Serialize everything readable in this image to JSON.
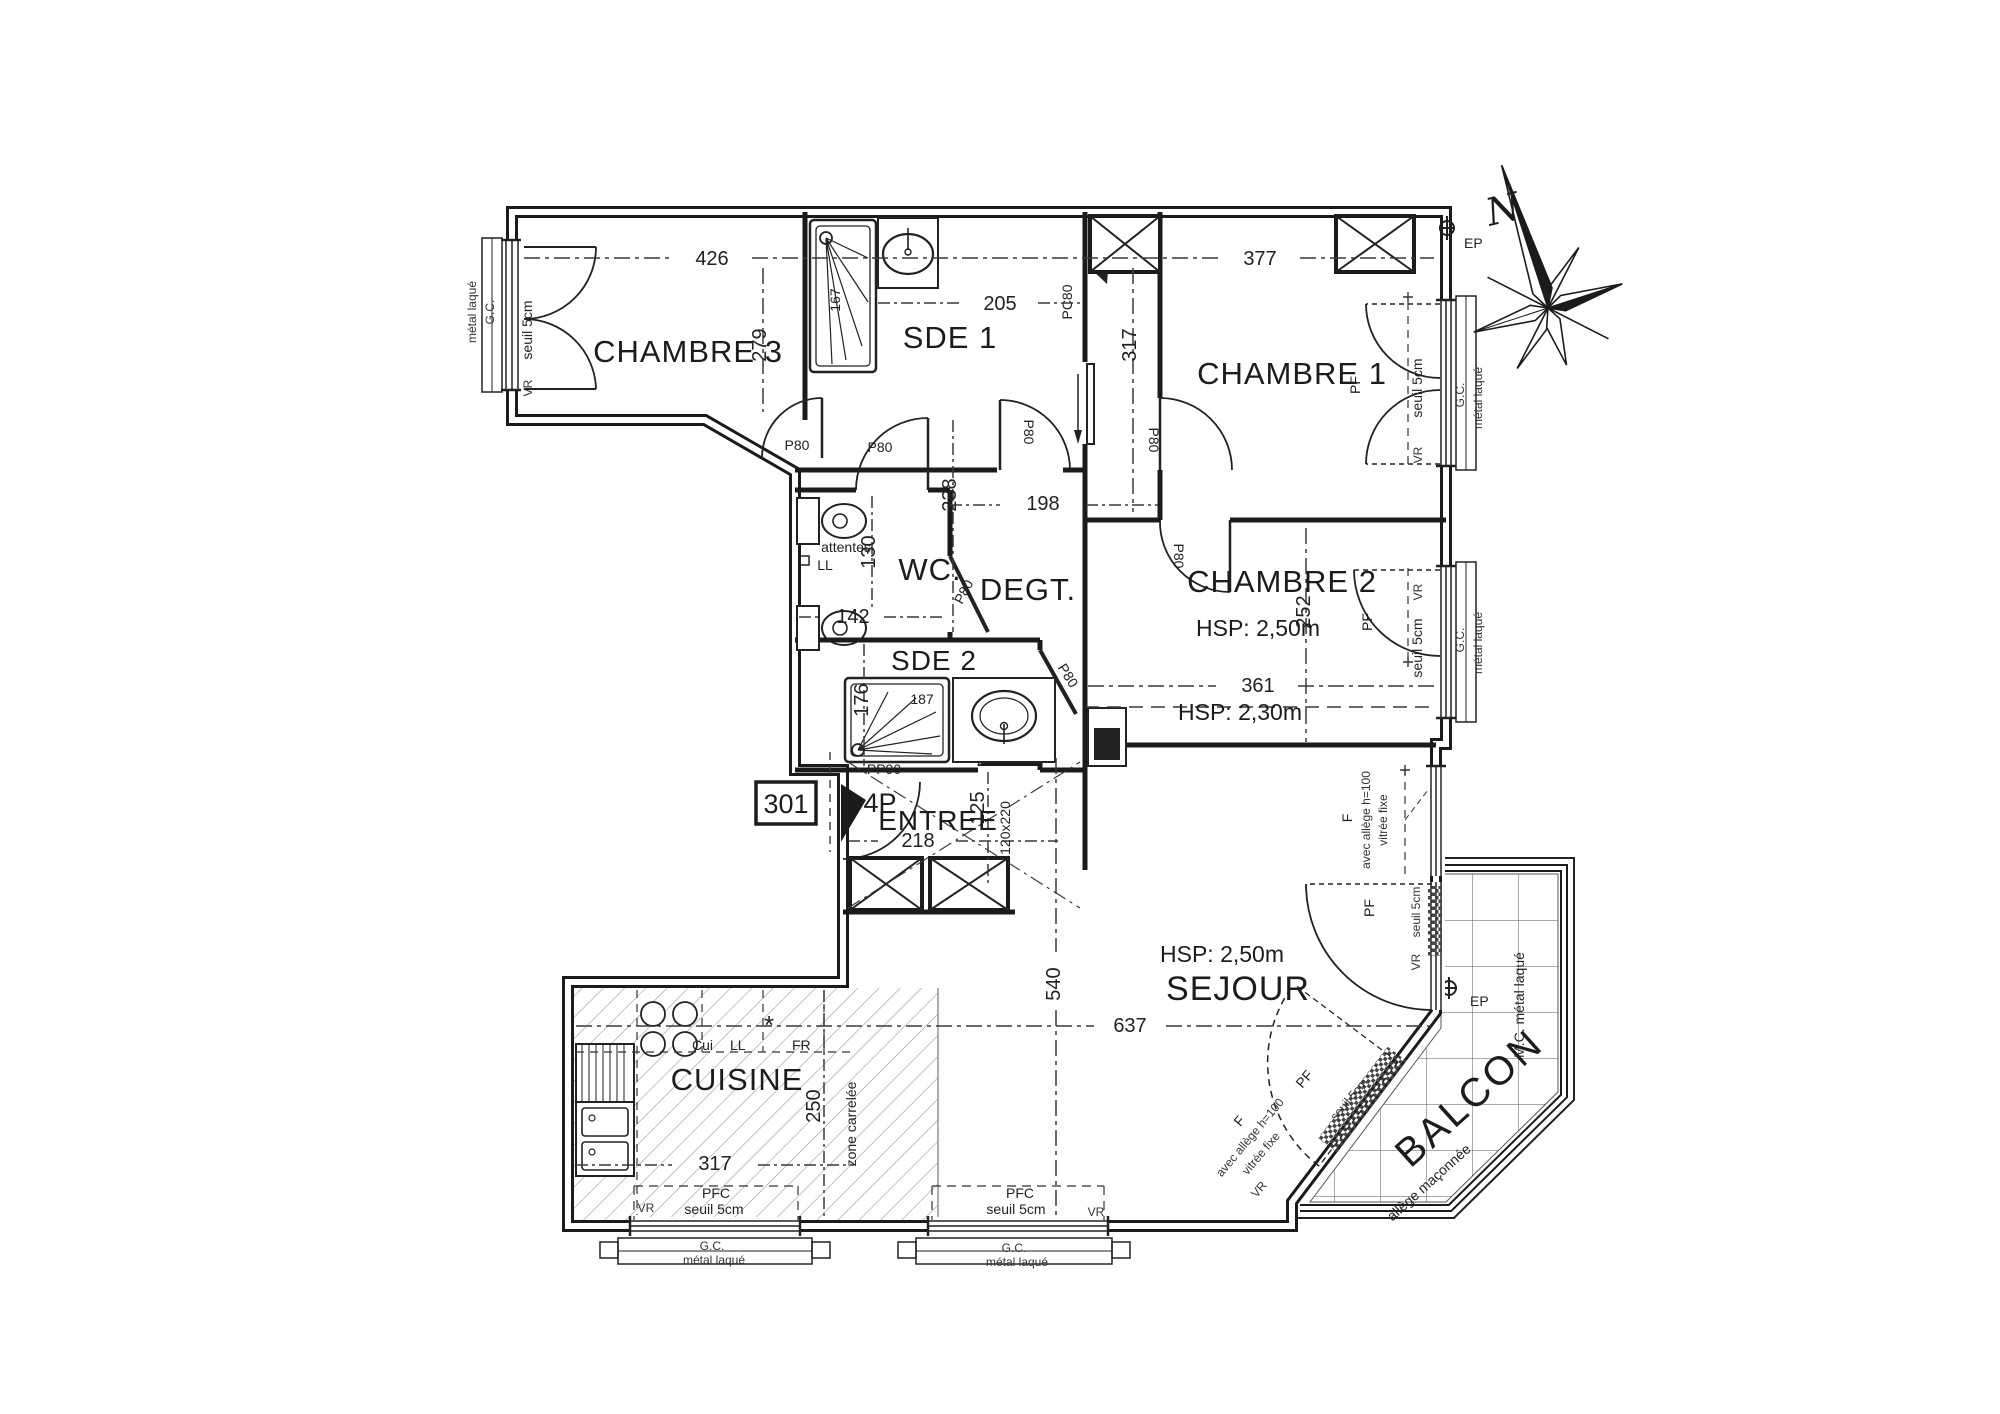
{
  "plan": {
    "north": "N",
    "apartment_number": "301",
    "rooms": {
      "chambre3": {
        "name": "CHAMBRE 3"
      },
      "sde1": {
        "name": "SDE 1"
      },
      "chambre1": {
        "name": "CHAMBRE 1"
      },
      "wc": {
        "name": "WC.",
        "note_attentes": "attentes",
        "note_ll": "LL"
      },
      "degt": {
        "name": "DEGT."
      },
      "chambre2": {
        "name": "CHAMBRE 2",
        "hsp": "HSP: 2,50m",
        "hsp_low": "HSP: 2,30m"
      },
      "sde2": {
        "name": "SDE 2"
      },
      "entree": {
        "name": "ENTREE",
        "door": "4P",
        "door_size": "PP90",
        "trap": "120x220"
      },
      "sejour": {
        "name": "SEJOUR",
        "hsp": "HSP: 2,50m"
      },
      "cuisine": {
        "name": "CUISINE",
        "floor": "zone carrelée",
        "hob": "Cui",
        "washer": "LL",
        "star": "*",
        "fridge": "FR"
      },
      "balcon": {
        "name": "BALCON",
        "allege": "allège maçonnée",
        "frame": "M.C. métal laqué"
      }
    },
    "dims": {
      "chambre3_w": "426",
      "chambre3_h": "279",
      "sde1_w": "205",
      "sde1_shower": "167",
      "chambre1_w": "377",
      "chambre1_h": "317",
      "wc_h": "130",
      "wc_w": "142",
      "degt_h": "238",
      "degt_w": "198",
      "chambre2_h": "252",
      "chambre2_w": "361",
      "sde2_h": "176",
      "sde2_shower": "187",
      "entree_w": "218",
      "entree_h": "125",
      "sejour_h": "540",
      "sejour_w": "637",
      "cuisine_w": "317",
      "cuisine_h": "250"
    },
    "win": {
      "vr": "VR",
      "seuil": "seuil 5cm",
      "gc": "G.C.",
      "metal": "métal laqué",
      "pfc": "PFC",
      "pf": "PF",
      "p80": "P80",
      "pc80": "PC80",
      "f": "F",
      "allege": "avec allège h=100",
      "vitree": "vitrée fixe",
      "ep": "EP"
    }
  }
}
